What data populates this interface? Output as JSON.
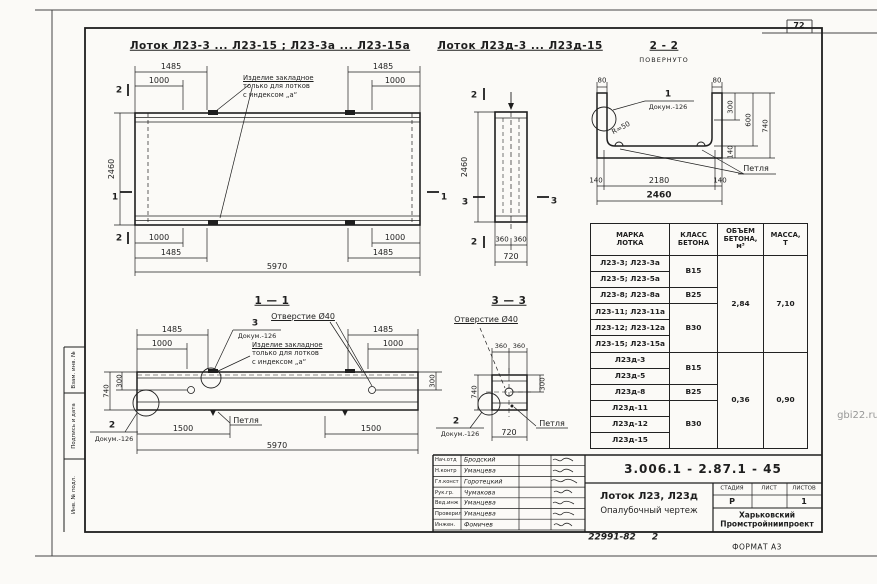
{
  "page": {
    "number": "72",
    "watermark": "gbi22.ru",
    "format": "ФОРМАТ А3",
    "footer_num": "22991-82",
    "footer_sheet": "2"
  },
  "titles": {
    "plan_a": "Лоток Л23-3 ... Л23-15 ; Л23-3а ... Л23-15а",
    "plan_d": "Лоток Л23д-3 ... Л23д-15",
    "sec22": "2 - 2",
    "sec22_note": "ПОВЕРНУТО",
    "sec11": "1 — 1",
    "sec33": "3 — 3"
  },
  "labels": {
    "embed1": "Изделие закладное",
    "embed2": "только для лотков",
    "embed3": "с индексом „а“",
    "hole": "Отверстие Ø40",
    "loop": "Петля",
    "doc": "Докум.-126",
    "radius": "R=50",
    "c1": "1",
    "c2": "2",
    "c3": "3"
  },
  "dims": {
    "d80": "80",
    "d140": "140",
    "d300": "300",
    "d360": "360",
    "d600": "600",
    "d720": "720",
    "d740": "740",
    "d1000": "1000",
    "d1485": "1485",
    "d1500": "1500",
    "d2180": "2180",
    "d2460": "2460",
    "d5970": "5970"
  },
  "marks": {
    "m1": "1",
    "m2": "2",
    "m3": "3"
  },
  "table": {
    "headers": [
      "МАРКА\nЛОТКА",
      "КЛАСС\nБЕТОНА",
      "ОБЪЕМ\nБЕТОНА,\nм³",
      "МАССА,\nТ"
    ],
    "marks": [
      "Л23-3; Л23-3а",
      "Л23-5; Л23-5а",
      "Л23-8; Л23-8а",
      "Л23-11; Л23-11а",
      "Л23-12; Л23-12а",
      "Л23-15; Л23-15а",
      "Л23д-3",
      "Л23д-5",
      "Л23д-8",
      "Л23д-11",
      "Л23д-12",
      "Л23д-15"
    ],
    "classes": {
      "g1": "В15",
      "g2": "В25",
      "g3": "В30",
      "g4": "В15",
      "g5": "В25",
      "g6": "В30"
    },
    "volumes": {
      "top": "2,84",
      "bottom": "0,36"
    },
    "masses": {
      "top": "7,10",
      "bottom": "0,90"
    }
  },
  "titleblock": {
    "doc_number": "3.006.1 - 2.87.1 - 45",
    "product1": "Лоток Л23, Л23д",
    "product2": "Опалубочный чертеж",
    "stage_h": [
      "СТАДИЯ",
      "ЛИСТ",
      "ЛИСТОВ"
    ],
    "stage": "Р",
    "sheet": "",
    "sheets": "1",
    "org1": "Харьковский",
    "org2": "Промстройниипроект",
    "sig_rows": [
      {
        "role": "Нач.отд",
        "name": "Бродский"
      },
      {
        "role": "Н.контр",
        "name": "Уманцева"
      },
      {
        "role": "Гл.конст",
        "name": "Горотецкий"
      },
      {
        "role": "Рук.гр.",
        "name": "Чумакова"
      },
      {
        "role": "Вед.инж",
        "name": "Уманцева"
      },
      {
        "role": "Проверил",
        "name": "Уманцева"
      },
      {
        "role": "Инжен.",
        "name": "Фомичев"
      }
    ]
  },
  "side_strip": {
    "c1": "Взам. инв. №",
    "c2": "Подпись и дата",
    "c3": "Инв. № подл."
  }
}
